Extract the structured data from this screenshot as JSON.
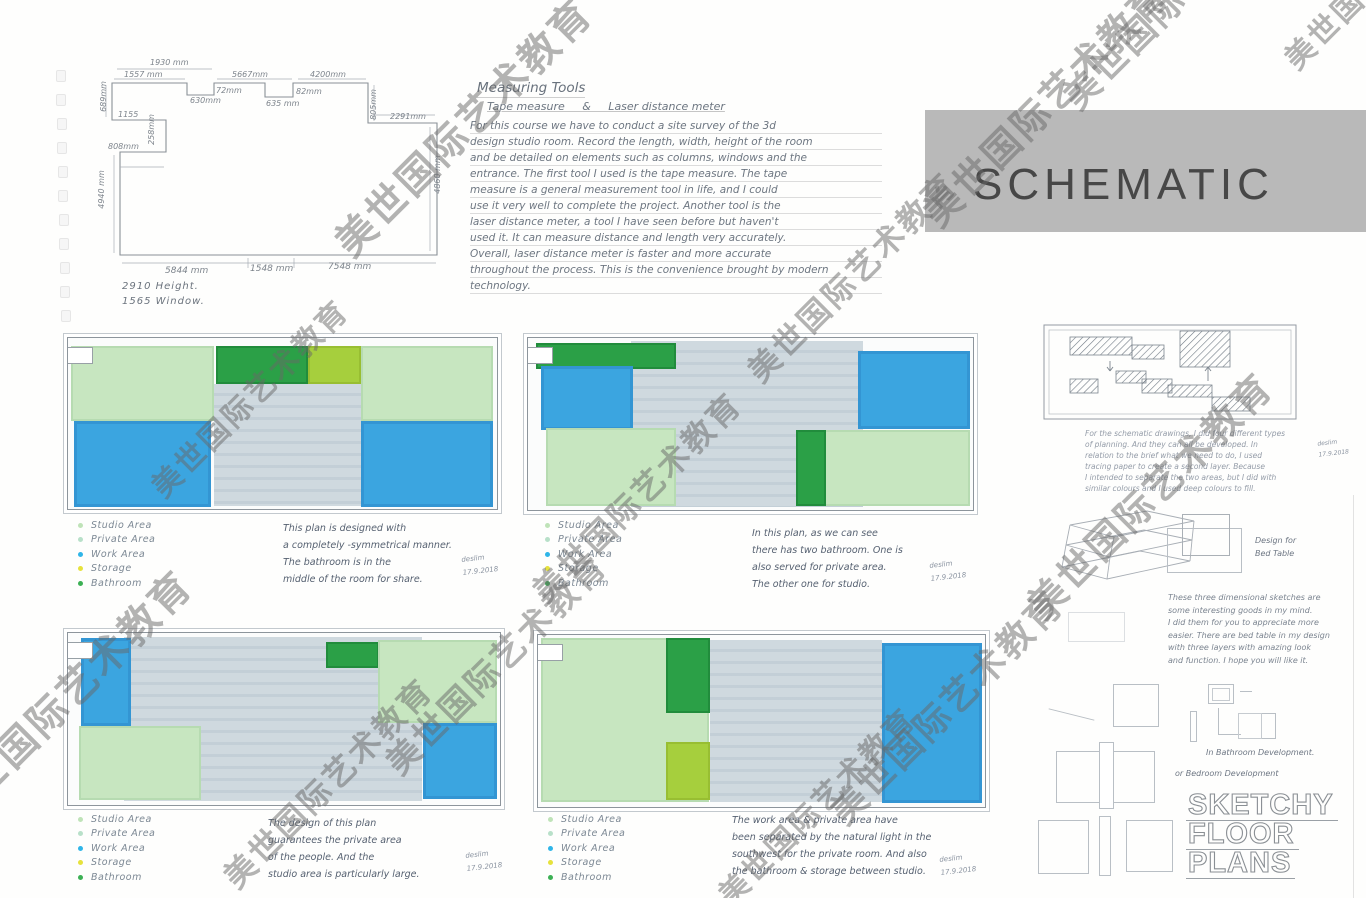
{
  "watermark": {
    "text": "美世国际艺术教育"
  },
  "palette": {
    "paper": "#fefefd",
    "banner_gray": "#b9b9b9",
    "studio_green": "#c7e6c0",
    "bathroom_green": "#2ba047",
    "storage_yellowgreen": "#a6cf3d",
    "work_blue": "#3ba5e0",
    "floor_gray": "#cfd9df",
    "legend_studio": "#bfe3b8",
    "legend_private": "#b8e0c9",
    "legend_work": "#2fb5e8",
    "legend_storage": "#e6e23c",
    "legend_bathroom": "#3cb054"
  },
  "banner": {
    "title": "SCHEMATIC"
  },
  "survey": {
    "dims": {
      "top_overall": "1930 mm",
      "top_left": "1557 mm",
      "top_mid": "5667mm",
      "top_right": "4200mm",
      "notch1": "630mm",
      "notch1_depth": "72mm",
      "notch2": "635 mm",
      "notch2_depth": "82mm",
      "left_top": "689mm",
      "left_small": "1155",
      "left_step": "258mm",
      "left_step2": "808mm",
      "left_side": "4940 mm",
      "right_top": "805mm",
      "right_inset": "2291mm",
      "right_side": "4860 mm",
      "bottom_left": "5844 mm",
      "bottom_mid": "1548 mm",
      "bottom_right": "7548 mm"
    },
    "note_height": "2910 Height.",
    "note_window": "1565 Window."
  },
  "measuring_tools": {
    "title": "Measuring Tools",
    "subtitle": "Tape measure     &     Laser distance meter",
    "body": "For this course we have to conduct a site survey of the 3d\ndesign studio room. Record the length, width, height of the room\nand be detailed on elements such as columns, windows and the\nentrance. The first tool I used is the tape measure. The tape\nmeasure is a general measurement tool in life, and I could\nuse it very well to complete the project. Another tool is the\nlaser distance meter, a tool I have seen before but haven't\nused it. It can measure distance and length very accurately.\nOverall, laser distance meter is faster and more accurate\nthroughout the process. This is the convenience brought by modern\ntechnology."
  },
  "legend": {
    "items": [
      {
        "label": "Studio Area",
        "color_key": "legend_studio"
      },
      {
        "label": "Private Area",
        "color_key": "legend_private"
      },
      {
        "label": "Work Area",
        "color_key": "legend_work"
      },
      {
        "label": "Storage",
        "color_key": "legend_storage"
      },
      {
        "label": "Bathroom",
        "color_key": "legend_bathroom"
      }
    ]
  },
  "plans": [
    {
      "note": "This plan is designed with\na completely -symmetrical manner.\nThe bathroom is in the\nmiddle of the room for share.",
      "sign": "deslim",
      "date": "17.9.2018"
    },
    {
      "note": "In this plan, as we can see\nthere has two bathroom. One is\nalso served for private area.\nThe other one for studio.",
      "sign": "deslim",
      "date": "17.9.2018"
    },
    {
      "note": "The design of this plan\nguarantees the private area\nof the people. And the\nstudio area is particularly large.",
      "sign": "deslim",
      "date": "17.9.2018"
    },
    {
      "note": "The work area & private area have\nbeen separated by the natural light in the\nsouthwest for the private room. And also\nthe bathroom & storage between studio.",
      "sign": "deslim",
      "date": "17.9.2018"
    }
  ],
  "right_panel": {
    "para1": "For the schematic drawings, I did four different types\nof planning. And they can all be developed. In\nrelation to the brief what we need to do, I used\ntracing paper to create a second layer. Because\nI intended to separate the two areas, but I did with\nsimilar colours and I used deep colours to fill.",
    "para1_sign": "deslim\n17.9.2018",
    "bed_label": "Design for\nBed Table",
    "para2": "These three dimensional sketches are\nsome interesting goods in my mind.\nI did them for you to appreciate more\neasier. There are bed table in my design\nwith three layers with amazing look\nand function. I hope you will like it.",
    "caption1": "In Bathroom Development.",
    "caption2": "or Bedroom Development",
    "title_lines": [
      "SKETCHY",
      "FLOOR",
      "PLANS"
    ]
  }
}
